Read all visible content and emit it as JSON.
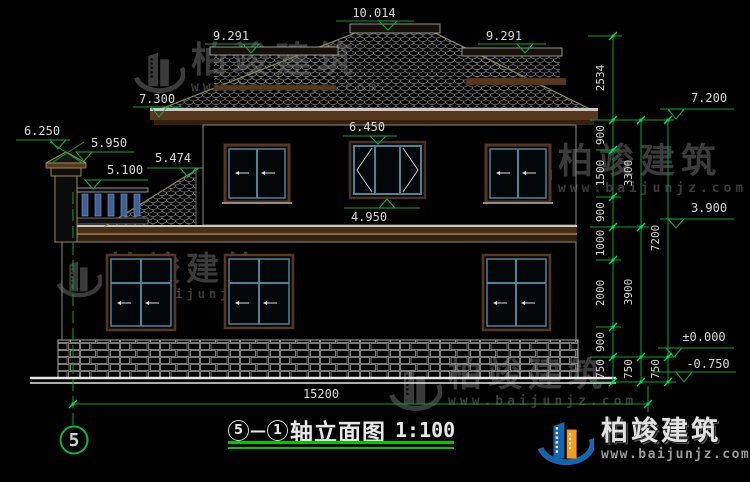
{
  "drawing": {
    "title": {
      "axis_start": "5",
      "dash": "—",
      "axis_end": "1",
      "name": "轴立面图",
      "scale": "1:100"
    },
    "axis_bubble": "5",
    "elevations": {
      "ridge": "10.014",
      "left_wing_ridge": "9.291",
      "right_wing_ridge": "9.291",
      "left_eave": "7.300",
      "right_eave": "7.200",
      "chimney_top": "6.250",
      "chimney_cap": "5.950",
      "parapet_top": "5.100",
      "wing_roof_top": "5.474",
      "window_head": "6.450",
      "window_sill": "4.950",
      "second_floor": "3.900",
      "ground_floor": "±0.000",
      "site_ground": "-0.750"
    },
    "dim_chains": {
      "inner": [
        "2534",
        "900",
        "1500",
        "900",
        "1000",
        "2000",
        "900",
        "750"
      ],
      "middle": [
        "3300",
        "3900",
        "750"
      ],
      "outer": [
        "7200",
        "750"
      ],
      "overall_width": "15200"
    }
  },
  "watermark": {
    "brand": "柏竣建筑",
    "site": "www.baijunjz.com"
  },
  "logo": {
    "brand": "柏竣建筑",
    "site": "www.baijunjz.com"
  },
  "colors": {
    "background": "#000000",
    "dimension_green": "#00a33c",
    "bright_green": "#00e052",
    "underline_green": "#00c800",
    "text_gray": "#d9d9d9",
    "fascia_brown": "#58371d",
    "window_teal": "#4e8296",
    "watermark_gray": "#3b3b3b",
    "logo_blue": "#1565b0",
    "logo_orange": "#f59b20"
  }
}
